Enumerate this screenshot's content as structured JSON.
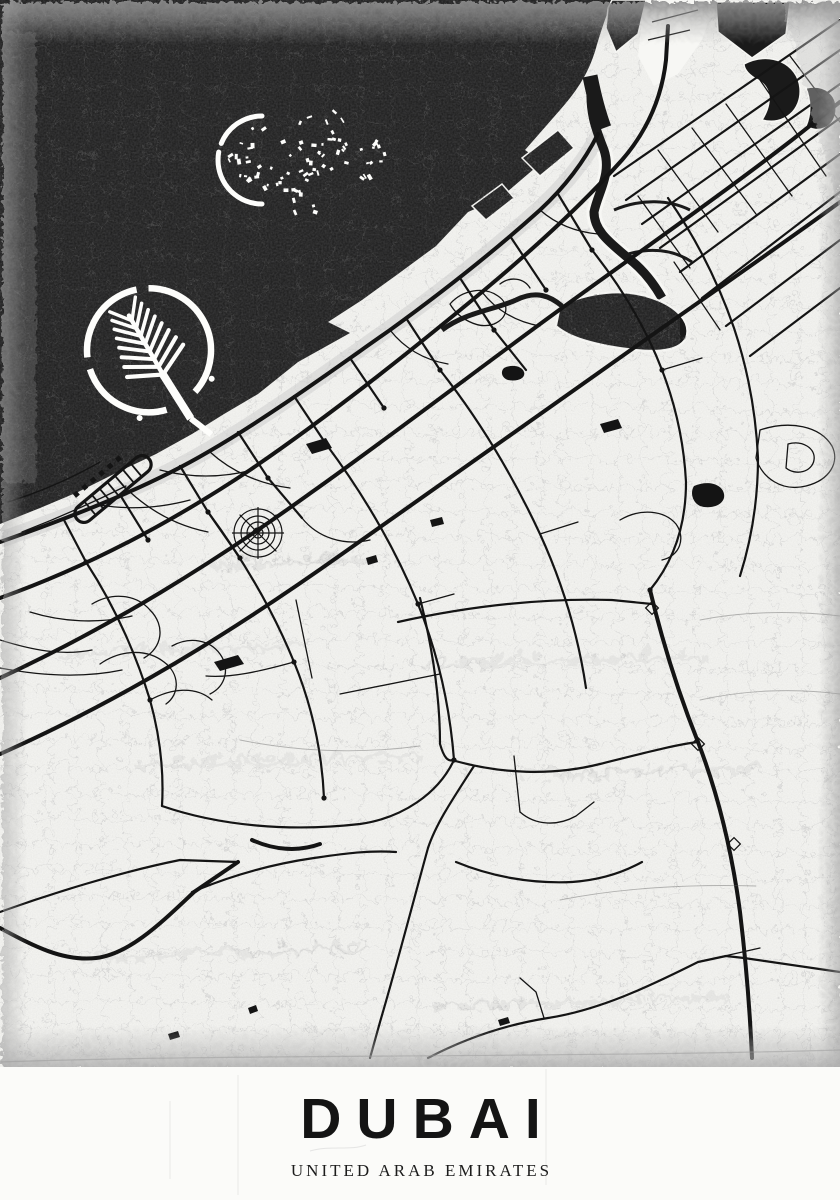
{
  "poster": {
    "title": "DUBAI",
    "subtitle": "UNITED ARAB EMIRATES",
    "colors": {
      "paper": "#f7f7f4",
      "sea": "#1a1a1a",
      "road": "#141414",
      "island": "#fdfdfb",
      "crack_land": "#c9c9c9",
      "crack_sea": "#5f5f5f",
      "edge_gray": "#9a9a9a",
      "title_text": "#141414"
    }
  },
  "map": {
    "texture": {
      "cell": 26,
      "land_opacity": 0.55,
      "sea_cell": 34
    },
    "sea": "M0 0 L612 0 C604 22 600 34 596 48 C588 76 574 94 560 110 L525 150 L542 162 L500 198 L468 212 L436 246 L398 274 L362 300 L328 322 L350 333 L298 362 L258 394 L224 414 L192 434 L156 454 L118 472 L78 492 L40 508 L0 524 Z",
    "shore": "M0 540 C80 512 150 484 208 450 C270 414 330 370 390 328 C448 286 500 244 540 208 C568 182 588 156 600 132",
    "water": {
      "blobs": [
        "M612 0 L646 0 L638 34 L616 52 L606 28 L608 8 Z",
        "M716 2 L790 2 L786 34 L752 58 L718 32 Z",
        "M744 64 C770 50 798 64 800 88 C802 110 784 126 762 120 C772 104 772 88 758 80 C750 76 744 70 744 64 Z",
        "M806 88 C824 84 838 94 836 112 C834 128 818 134 806 126 C812 112 810 98 806 88 Z",
        "M522 158 L558 130 L574 148 L540 176 Z",
        "M472 206 L502 184 L514 198 L486 220 Z"
      ],
      "creek": "M592 80 C588 110 596 130 604 150 C612 174 598 192 594 212 C594 232 612 244 628 258 C644 270 654 284 662 298",
      "creek_casing": "M604 150 C612 174 598 192 594 212 C594 232 612 244 628 258 C644 270 654 284 662 298",
      "creek_mouth": "M590 76 C594 96 598 112 604 128",
      "channels": [
        "M622 256 C650 246 674 250 692 262",
        "M614 210 C642 198 670 200 690 210"
      ],
      "sanctuary": "M560 306 C588 292 624 288 652 298 C676 306 692 322 686 338 C678 354 648 352 620 348 C594 344 570 338 556 326 Z",
      "peninsula": "M646 0 L716 0 L702 40 L678 74 L654 86 L638 56 L642 20 Z",
      "piers": [
        "M652 22 L698 10",
        "M648 40 L690 30"
      ]
    },
    "world": {
      "crescent": "M262 116 A44 44 0 0 0 262 204",
      "clusters": [
        {
          "cx": 262,
          "cy": 158,
          "r": 34,
          "n": 26,
          "seed": 3
        },
        {
          "cx": 338,
          "cy": 150,
          "r": 48,
          "n": 46,
          "seed": 9
        },
        {
          "cx": 300,
          "cy": 198,
          "r": 20,
          "n": 10,
          "seed": 17
        }
      ]
    },
    "palm": {
      "cx": 150,
      "cy": 352,
      "rotate": -30,
      "crescent_r": 62,
      "crescent_dash": "78 34 96 12 92 12 66"
    },
    "marina": {
      "x": 113,
      "y": 489,
      "rotate": -40
    },
    "road_styles": {
      "major": 4.0,
      "medium": 2.2,
      "minor": 1.3,
      "fine": 0.9
    },
    "roads": {
      "major": [
        "M0 542 C80 514 150 486 208 452 C270 416 330 372 390 330 C448 288 500 246 540 210 C568 184 586 158 598 134",
        "M0 598 C90 566 172 522 250 470 C332 414 412 350 482 292 C542 242 588 198 622 160 C648 130 662 96 666 60 L668 26",
        "M0 678 C112 626 212 564 312 492 C402 428 482 366 562 308 C642 250 722 194 792 140 L840 102",
        "M0 754 C122 700 232 632 342 554 C452 476 562 398 662 328 C742 272 802 230 840 202",
        "M650 590 C662 640 678 692 698 742 C718 794 732 852 740 912 C746 962 750 1012 752 1058",
        "M252 840 C274 850 298 852 320 844",
        "M0 928 C30 944 62 962 96 958 C130 954 162 922 194 892 L238 862"
      ],
      "medium": [
        "M64 520 L86 562",
        "M122 498 L148 540",
        "M180 466 L208 512",
        "M238 432 L268 478",
        "M294 396 L326 444",
        "M350 358 L384 408",
        "M406 318 L440 370",
        "M460 278 L494 330",
        "M510 236 L546 290",
        "M558 194 L592 250",
        "M268 478 L302 518",
        "M494 330 L526 370",
        "M208 512 L240 558",
        "M86 562 C112 602 134 648 150 700 C160 736 164 772 162 806",
        "M208 512 C242 558 272 608 294 662 C312 706 322 752 324 798",
        "M326 444 C362 492 394 546 418 604 C438 654 450 708 454 760",
        "M440 370 C478 418 512 474 540 534 C562 582 578 634 586 688",
        "M592 250 C622 288 646 328 662 370 C676 406 684 444 686 482 C686 518 678 556 650 590",
        "M668 198 C696 238 718 282 734 328 C748 370 756 414 758 458 C758 498 752 538 740 576",
        "M614 176 L840 20",
        "M626 200 L840 50",
        "M642 224 L840 84",
        "M660 248 L840 118",
        "M680 272 L840 154",
        "M702 298 L840 192",
        "M726 326 L840 240",
        "M750 356 L840 288",
        "M398 622 C470 606 540 598 612 600 L652 604",
        "M474 766 C452 800 436 824 428 848 C412 906 396 968 380 1022 L370 1058",
        "M420 598 C432 646 440 696 440 744 C444 758 448 762 454 760",
        "M0 912 C50 894 120 872 180 860 L238 862",
        "M428 1058 C470 1036 510 1024 548 1018 C600 1010 650 986 698 962 L726 956 L744 958 L840 972",
        "M452 760 C500 774 552 776 600 764 C640 754 678 744 698 742",
        "M192 892 C230 876 272 864 314 858 C342 854 368 850 396 852",
        "M162 806 C220 826 290 832 360 824 C402 818 438 794 454 760",
        "M456 862 C490 876 530 884 572 882 C602 880 624 872 642 862"
      ],
      "minor": [
        "M92 604 C112 592 136 594 150 610 C166 626 162 648 144 658",
        "M100 664 C120 650 146 648 164 662 C180 674 180 694 166 704",
        "M172 646 C190 636 210 640 220 654 C230 668 226 686 210 694",
        "M150 700 C172 688 196 686 212 700",
        "M294 662 C258 672 230 678 206 676",
        "M296 600 L312 678",
        "M340 694 L440 674",
        "M8 502 C40 492 72 478 100 462",
        "M22 532 C58 518 94 502 126 486",
        "M0 640 C32 650 62 656 92 650",
        "M0 668 C42 676 84 678 122 670",
        "M30 612 C62 622 98 624 132 616",
        "M130 492 C152 512 178 526 208 532",
        "M210 452 C232 472 260 484 290 488",
        "M302 518 C318 538 344 546 370 540",
        "M390 330 C404 348 424 360 448 364",
        "M482 292 C496 310 516 322 540 326",
        "M540 210 C556 224 576 232 598 234",
        "M418 604 L454 594",
        "M540 534 L578 522",
        "M662 370 L702 358",
        "M514 756 L520 812",
        "M520 812 C536 826 558 826 576 816 L594 802",
        "M544 1018 L536 992 L520 978",
        "M698 962 L760 948",
        "M658 150 L718 232",
        "M692 128 L756 214",
        "M726 104 L792 196",
        "M760 80 L826 176",
        "M790 56 L840 122",
        "M638 196 L690 268",
        "M674 262 L720 330",
        "M760 430 C790 420 820 426 832 446 C840 462 830 480 806 486 C782 492 762 478 756 458 Z",
        "M788 444 C802 440 816 448 814 460 C812 472 796 476 786 468 Z",
        "M620 520 C640 508 664 510 676 524 C686 538 680 556 662 560",
        "M450 304 C462 290 484 286 498 296 C510 304 508 318 494 324 C478 330 458 318 450 304 Z",
        "M500 284 C510 276 524 278 530 288",
        "M160 470 C190 478 222 478 252 470",
        "M100 505 C130 510 160 508 190 500"
      ],
      "fine": [
        "M700 620 C740 612 790 610 840 616",
        "M700 700 C744 690 794 688 840 694",
        "M560 900 C620 888 690 884 756 886",
        "M240 740 C300 752 360 754 420 746"
      ]
    },
    "canal": "M442 330 C466 312 494 310 516 300 C536 290 550 296 562 306",
    "blobs": [
      "M214 662 L238 655 L244 664 L220 671 Z",
      "M306 444 L326 438 L332 448 L312 454 Z",
      "M504 368 C512 364 522 366 524 372 C526 378 518 382 508 380 C502 378 500 372 504 368 Z",
      "M600 424 L618 419 L622 428 L604 433 Z",
      "M694 486 C708 480 722 484 724 494 C726 504 712 510 700 506 C692 502 690 492 694 486 Z",
      "M430 520 L442 517 L444 524 L432 527 Z",
      "M366 558 L376 555 L378 562 L368 565 Z",
      "M168 1034 L178 1031 L180 1037 L170 1040 Z",
      "M248 1008 L256 1005 L258 1011 L250 1014 Z",
      "M498 1020 L508 1017 L510 1023 L500 1026 Z"
    ],
    "junctions": [
      [
        86,
        562
      ],
      [
        148,
        540
      ],
      [
        208,
        512
      ],
      [
        268,
        478
      ],
      [
        326,
        444
      ],
      [
        384,
        408
      ],
      [
        440,
        370
      ],
      [
        494,
        330
      ],
      [
        546,
        290
      ],
      [
        592,
        250
      ],
      [
        650,
        590
      ],
      [
        454,
        760
      ],
      [
        324,
        798
      ],
      [
        662,
        370
      ],
      [
        240,
        558
      ],
      [
        150,
        700
      ],
      [
        294,
        662
      ],
      [
        418,
        604
      ]
    ],
    "interchanges": [
      [
        652,
        608
      ],
      [
        698,
        744
      ],
      [
        734,
        844
      ]
    ],
    "web": {
      "cx": 258,
      "cy": 533,
      "radii": [
        5,
        11,
        17,
        24
      ],
      "spokes": 8,
      "spoke_len": 26
    },
    "smudges": [
      "M60 648 L300 640",
      "M420 660 L700 652",
      "M140 760 L420 752",
      "M520 770 L760 764",
      "M80 952 L360 944",
      "M430 1000 L720 992",
      "M200 560 L360 554"
    ],
    "scratches": [
      [
        238,
        8,
        238,
        128
      ],
      [
        546,
        2,
        546,
        118
      ],
      [
        170,
        34,
        170,
        112
      ]
    ],
    "scratch_mark": "M310 84 C330 78 350 84 366 78"
  }
}
